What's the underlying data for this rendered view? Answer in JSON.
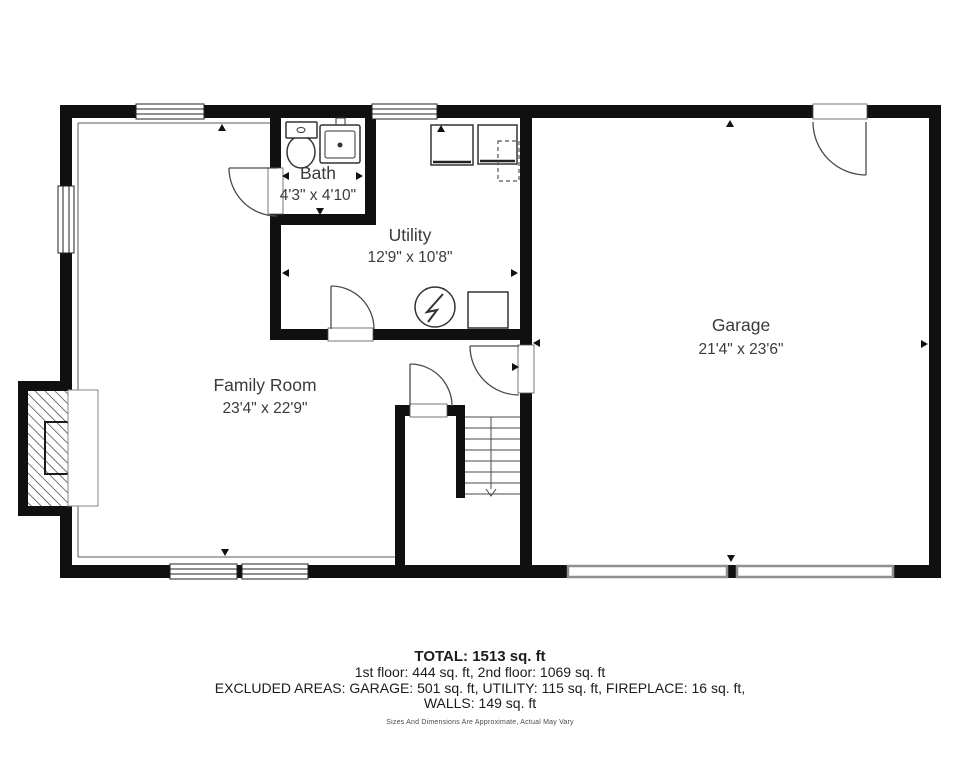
{
  "plan": {
    "rooms": {
      "family_room": {
        "name": "Family Room",
        "dims": "23'4\" x 22'9\""
      },
      "garage": {
        "name": "Garage",
        "dims": "21'4\" x 23'6\""
      },
      "utility": {
        "name": "Utility",
        "dims": "12'9\" x 10'8\""
      },
      "bath": {
        "name": "Bath",
        "dims": "4'3\" x 4'10\""
      }
    },
    "fixtures": [
      "toilet",
      "sink",
      "washer",
      "dryer",
      "water-heater",
      "storage-box",
      "fireplace",
      "staircase-down"
    ],
    "colors": {
      "wall": "#101010",
      "door_line": "#4a4a4a",
      "label": "#3b3b3b",
      "garage_door": "#8f8f8f"
    }
  },
  "summary": {
    "total": "TOTAL: 1513 sq. ft",
    "floors": "1st floor: 444 sq. ft, 2nd floor: 1069 sq. ft",
    "excluded": "EXCLUDED AREAS: GARAGE: 501 sq. ft, UTILITY: 115 sq. ft, FIREPLACE: 16 sq. ft,",
    "walls": "WALLS: 149 sq. ft",
    "disclaimer": "Sizes And Dimensions Are Approximate, Actual May Vary"
  }
}
